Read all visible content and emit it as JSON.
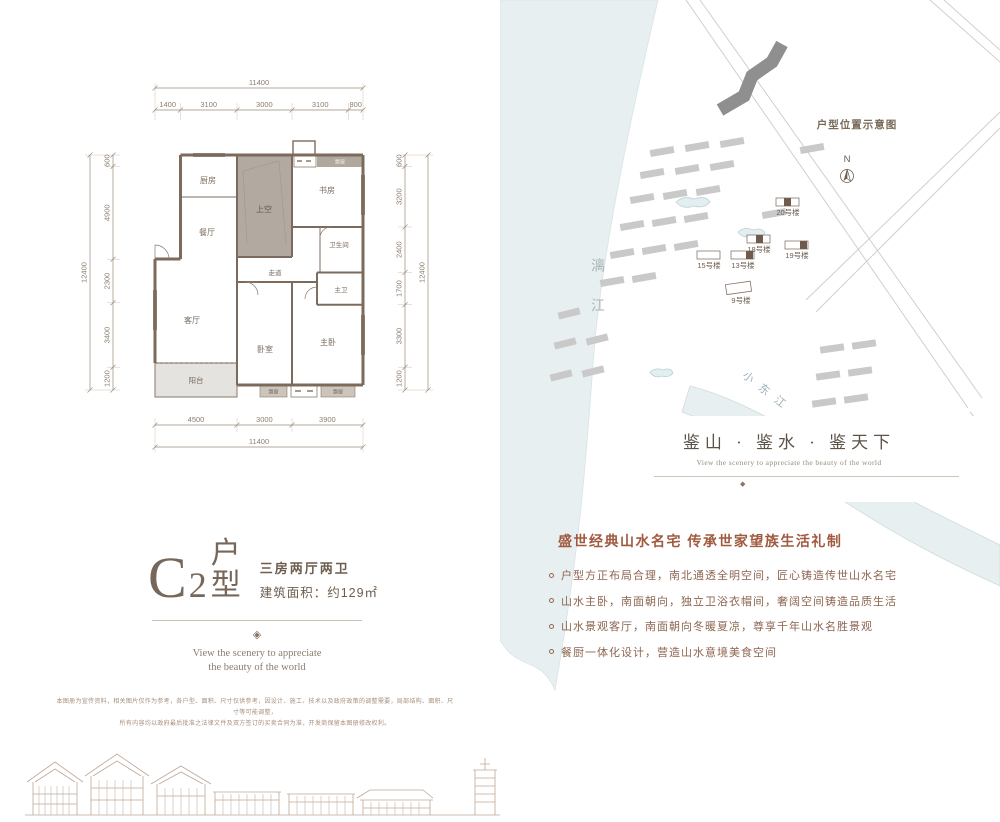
{
  "unit": {
    "series_letter": "C",
    "series_number": "2",
    "series_suffix": "户型",
    "layout": "三房两厅两卫",
    "area": "建筑面积：约129㎡",
    "tagline1": "View the scenery to appreciate",
    "tagline2": "the beauty of the world",
    "ornament_glyph": "◈"
  },
  "floorplan": {
    "dim_top_total": "11400",
    "dim_top": [
      "1400",
      "3100",
      "3000",
      "3100",
      "800"
    ],
    "dim_left_total": "12400",
    "dim_left": [
      "600",
      "4900",
      "2300",
      "3400",
      "1200"
    ],
    "dim_right_total": "12400",
    "dim_right": [
      "600",
      "3200",
      "2400",
      "1700",
      "3300",
      "1200"
    ],
    "dim_bottom": [
      "4500",
      "3000",
      "3900"
    ],
    "dim_bottom_total": "11400",
    "rooms": {
      "kitchen": "厨房",
      "dining": "餐厅",
      "void": "上空",
      "study": "书房",
      "bathroom": "卫生间",
      "corridor": "走道",
      "master_bath": "主卫",
      "living": "客厅",
      "bedroom": "卧室",
      "master_bedroom": "主卧",
      "balcony": "阳台",
      "bay_window": "飘窗"
    }
  },
  "map": {
    "title": "户型位置示意图",
    "compass_label": "N",
    "river_left": "漓江",
    "river_right": "小东江",
    "buildings": [
      "20号楼",
      "19号楼",
      "18号楼",
      "15号楼",
      "13号楼",
      "9号楼"
    ],
    "slogan": "鉴山 · 鉴水 · 鉴天下",
    "slogan_en": "View the scenery to appreciate the beauty of the world",
    "box_ornament_glyph": "◆"
  },
  "features": {
    "heading": "盛世经典山水名宅 传承世家望族生活礼制",
    "bullets": [
      "户型方正布局合理，南北通透全明空间，匠心铸造传世山水名宅",
      "山水主卧，南面朝向，独立卫浴衣帽间，奢阔空间铸造品质生活",
      "山水景观客厅，南面朝向冬暖夏凉，尊享千年山水名胜景观",
      "餐厨一体化设计，营造山水意境美食空间"
    ]
  },
  "disclaimer": {
    "line1": "本图册为宣传资料，相关图片仅作为参考，各户型、面积、尺寸仅供参考，因设计、施工、技术以及政府政策的调整需要，局部结构、面积、尺寸等可能调整，",
    "line2": "所有内容均以政府最后批准之法律文件及双方签订的买卖合同为准，开发商保留本图册修改权利。"
  },
  "colors": {
    "wall_brown": "#7c6b5d",
    "dim_brown": "#8d7d6d",
    "text_brown": "#77675a",
    "heading_red_brown": "#a05a40",
    "water_blue": "#e7eff0",
    "building_gray": "#c9c9c9",
    "building_dark_gray": "#8f8f8f"
  }
}
